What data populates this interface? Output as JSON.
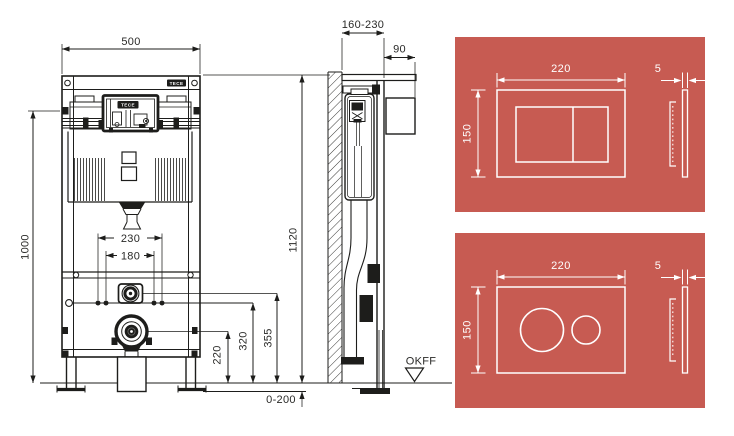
{
  "colors": {
    "background": "#ffffff",
    "line": "#1d1d1b",
    "panel_background": "#c75b52",
    "panel_line": "#ffffff"
  },
  "brand": {
    "logo": "TECE",
    "cistern_logo": "TECE"
  },
  "front_view": {
    "dims": {
      "frame_width": "500",
      "fixing_height": "1000",
      "anchor_spacing_outer": "230",
      "anchor_spacing_inner": "180",
      "drain_height": "220",
      "crossbar_height": "320",
      "water_inlet_height": "355"
    }
  },
  "side_view": {
    "dims": {
      "frame_height": "1120",
      "depth_range": "160-230",
      "cistern_offset": "90",
      "foot_adjustment": "0-200"
    },
    "floor_level_label": "OKFF"
  },
  "flush_plates": {
    "rectangular_plate": {
      "width": "220",
      "height": "150",
      "thickness": "5"
    },
    "round_plate": {
      "width": "220",
      "height": "150",
      "thickness": "5"
    }
  }
}
